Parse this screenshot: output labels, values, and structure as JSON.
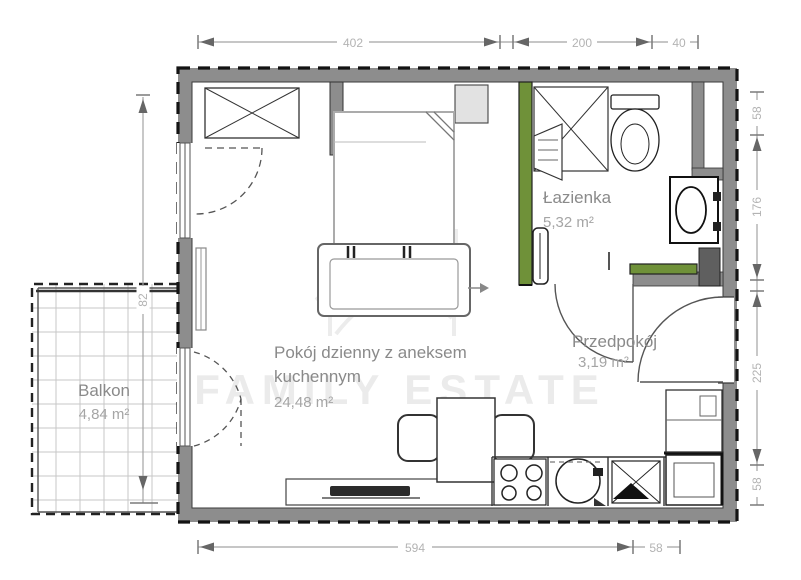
{
  "watermark": {
    "text": "FAMILY ESTATE"
  },
  "rooms": {
    "living": {
      "name_line1": "Pokój dzienny z aneksem",
      "name_line2": "kuchennym",
      "area": "24,48 m²"
    },
    "bathroom": {
      "name": "Łazienka",
      "area": "5,32 m²"
    },
    "hallway": {
      "name": "Przedpokój",
      "area": "3,19 m²"
    },
    "balcony": {
      "name": "Balkon",
      "area": "4,84 m²"
    }
  },
  "dimensions": {
    "top": {
      "d1": "402",
      "d2": "200",
      "d3": "40"
    },
    "right": {
      "d1": "58",
      "d2": "176",
      "d3": "225",
      "d4": "58"
    },
    "bottom": {
      "d1": "594",
      "d2": "58"
    },
    "left": {
      "d1": "82"
    }
  },
  "colors": {
    "wall_gray": "#8d8d8d",
    "accent_green": "#6f9139",
    "dim_line": "#a3a3a3",
    "label_gray": "#8a8a8a",
    "watermark_gray": "#ebebeb"
  }
}
